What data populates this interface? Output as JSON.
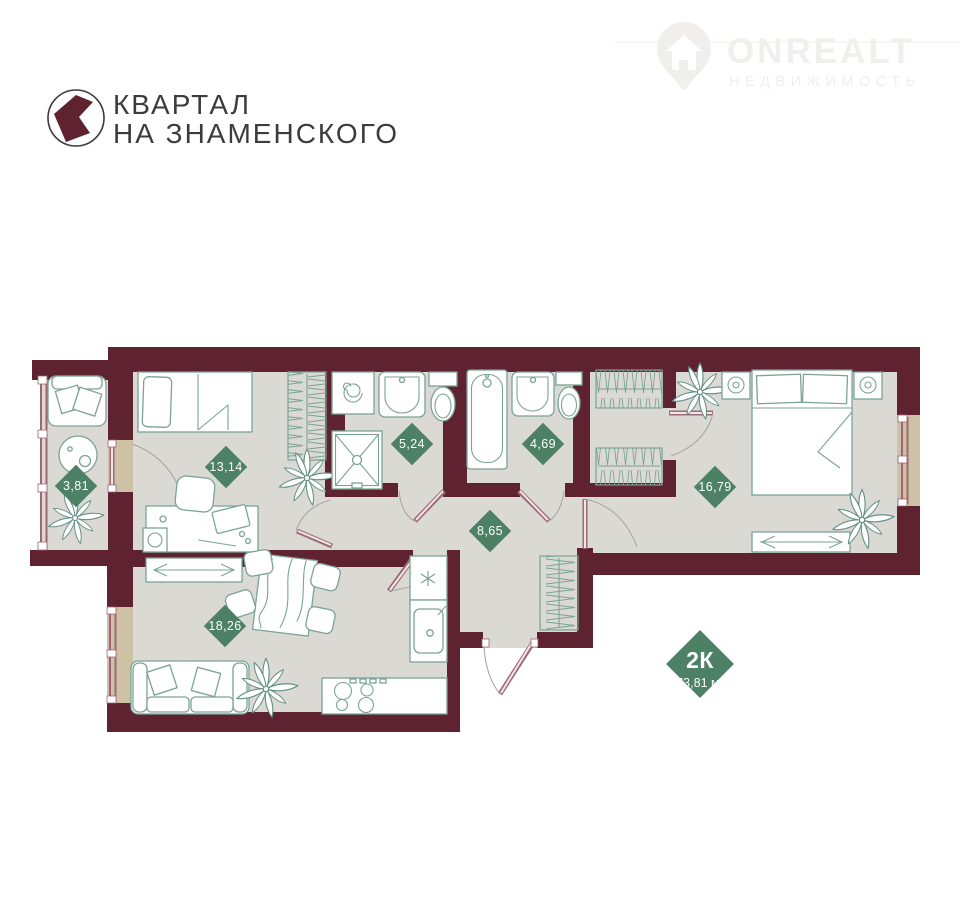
{
  "brand": {
    "line1": "КВАРТАЛ",
    "line2": "НА ЗНАМЕНСКОГО"
  },
  "watermark": {
    "title": "ONREALT",
    "subtitle": "НЕДВИЖИМОСТЬ"
  },
  "apartment": {
    "type": "2К",
    "area": "73,81 м²"
  },
  "rooms": {
    "balcony": {
      "area": "3,81"
    },
    "bedroom1": {
      "area": "13,14"
    },
    "bathroom1": {
      "area": "5,24"
    },
    "bathroom2": {
      "area": "4,69"
    },
    "hallway": {
      "area": "8,65"
    },
    "bedroom2": {
      "area": "16,79"
    },
    "living_kitchen": {
      "area": "18,26"
    }
  },
  "colors": {
    "wall": "#5e2231",
    "floor": "#dbd9d4",
    "accent_green": "#4d8166",
    "window_sill": "#cec2a6",
    "furniture_line": "#7ba396",
    "brand_maroon": "#5e2231"
  }
}
